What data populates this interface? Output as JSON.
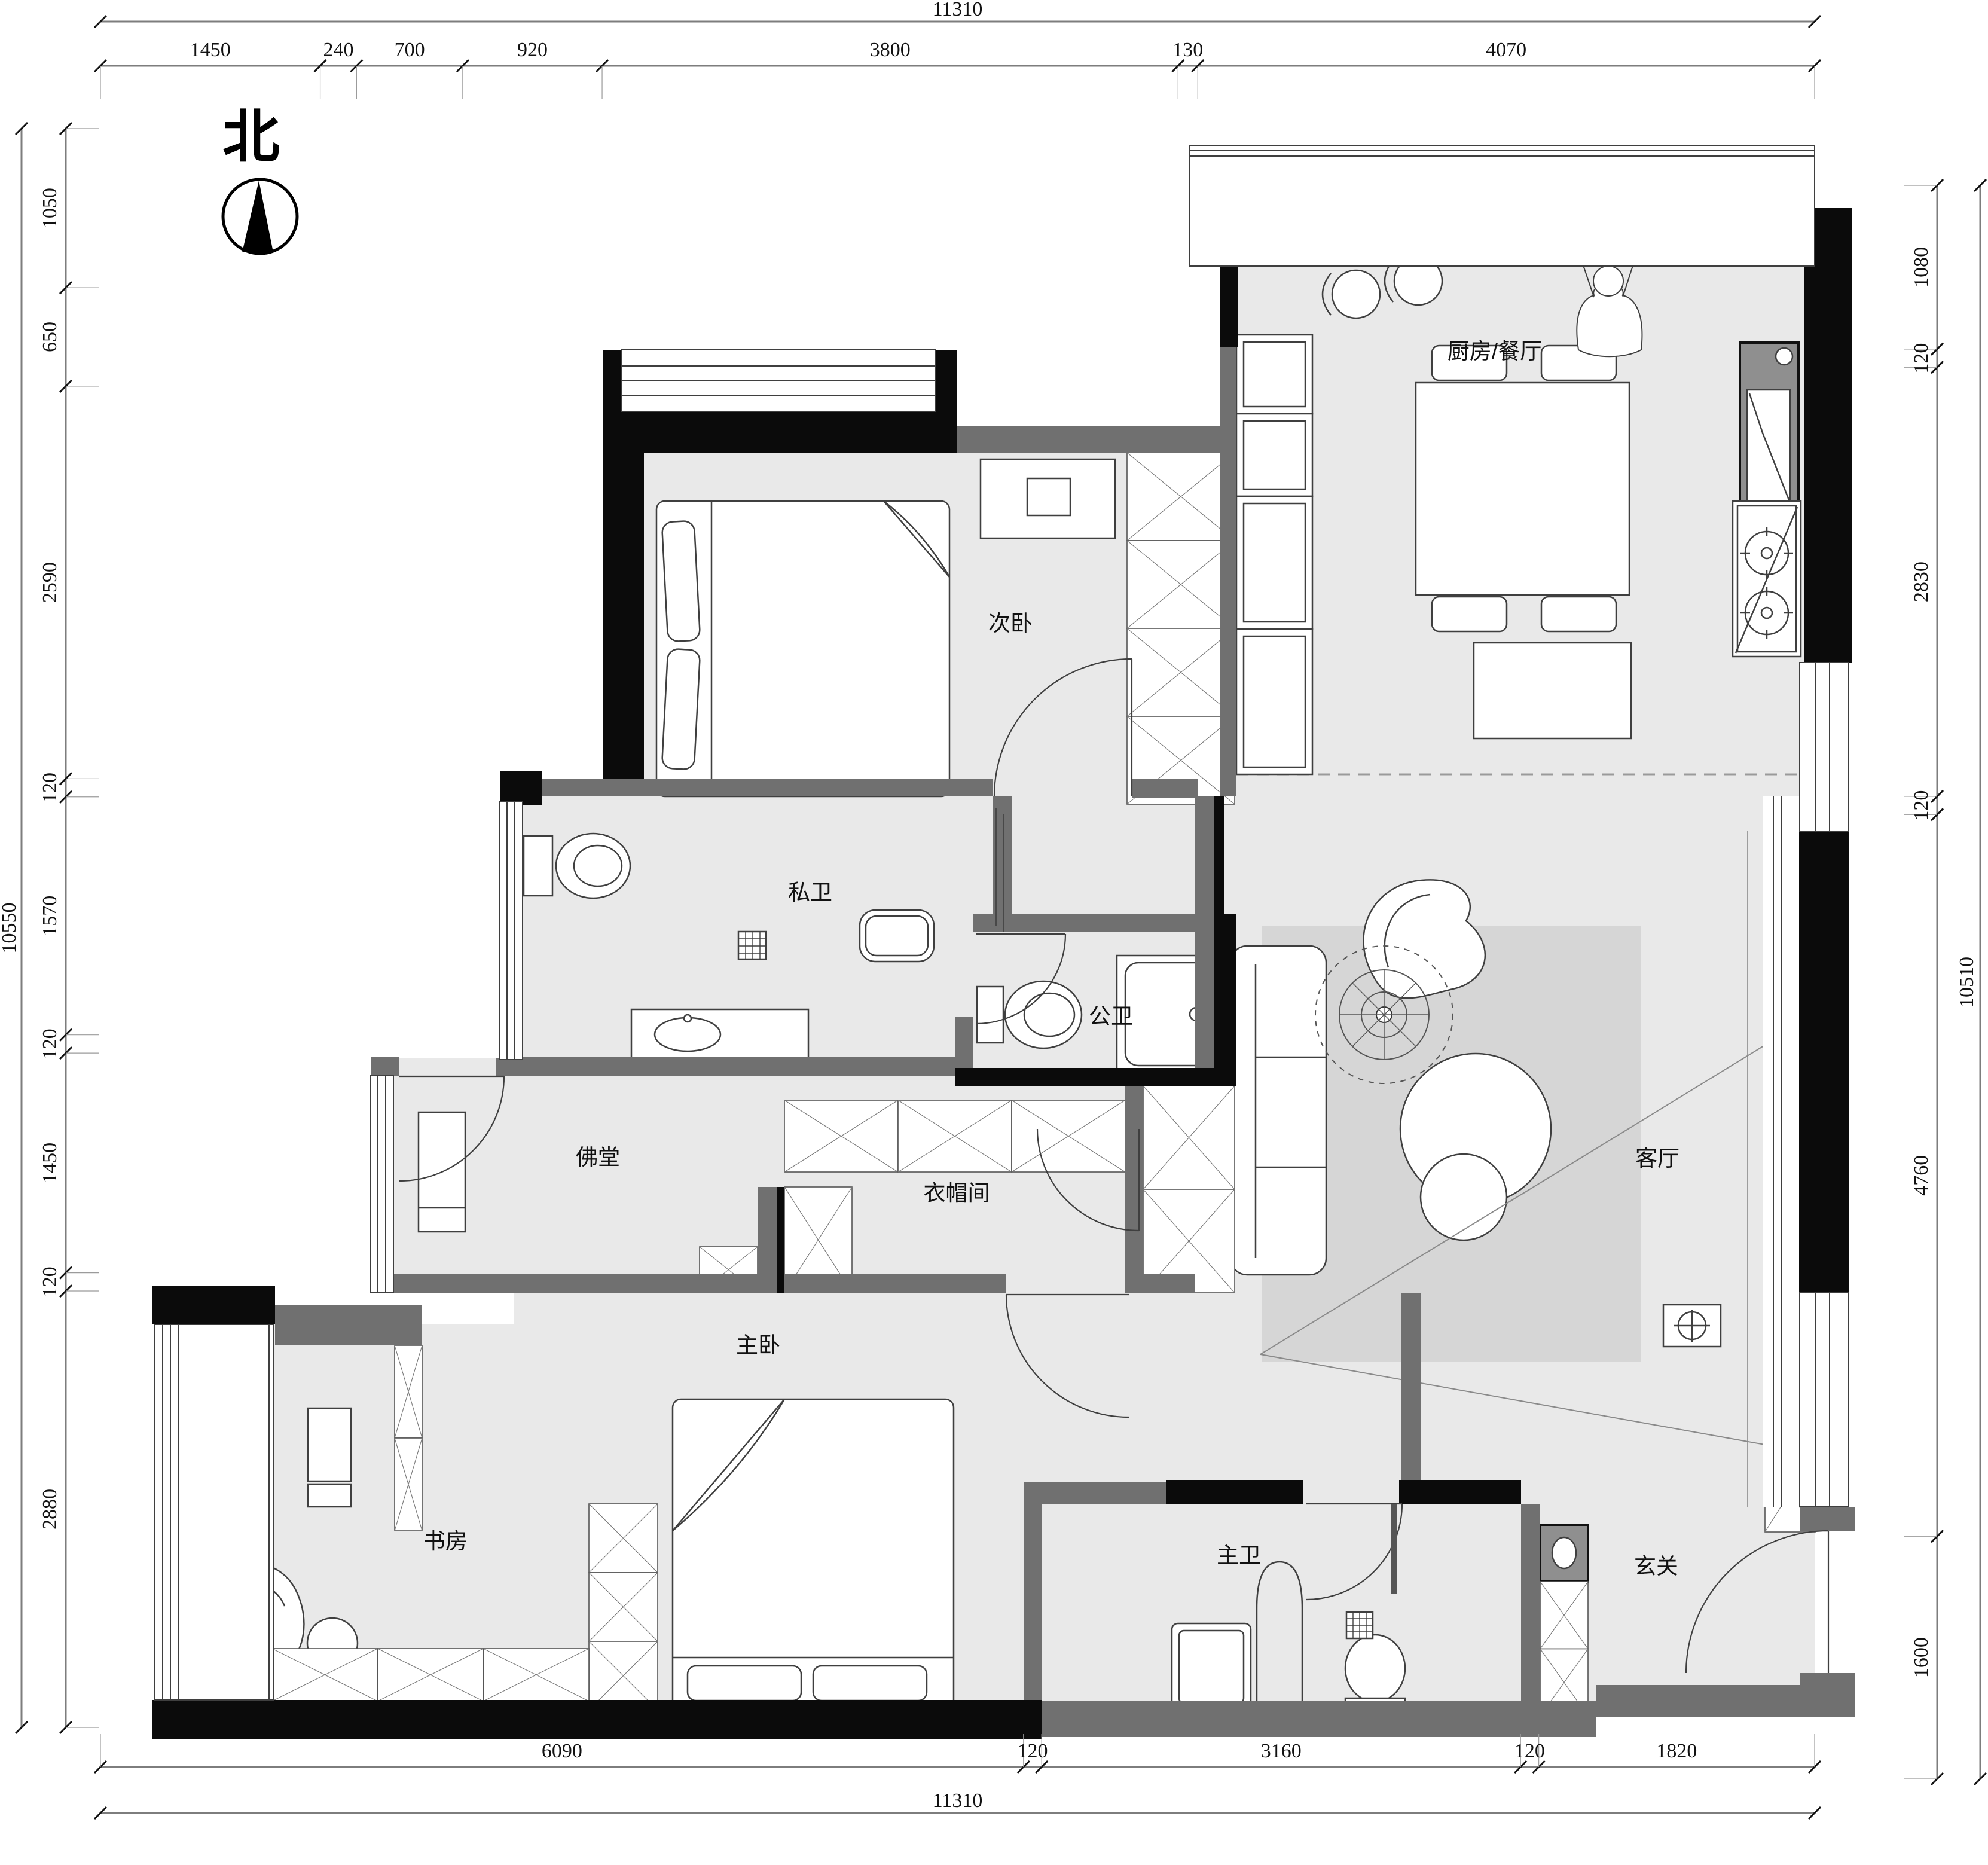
{
  "compass": {
    "label": "北"
  },
  "rooms": [
    {
      "id": "secondary-bedroom",
      "label": "次卧"
    },
    {
      "id": "kitchen-dining",
      "label": "厨房/餐厅"
    },
    {
      "id": "private-bath",
      "label": "私卫"
    },
    {
      "id": "public-bath",
      "label": "公卫"
    },
    {
      "id": "buddhist-hall",
      "label": "佛堂"
    },
    {
      "id": "cloakroom",
      "label": "衣帽间"
    },
    {
      "id": "living-room",
      "label": "客厅"
    },
    {
      "id": "master-bedroom",
      "label": "主卧"
    },
    {
      "id": "study",
      "label": "书房"
    },
    {
      "id": "master-bath",
      "label": "主卫"
    },
    {
      "id": "entryway",
      "label": "玄关"
    }
  ],
  "dimensions": {
    "top": {
      "total": 11310,
      "segments": [
        1450,
        240,
        700,
        920,
        3800,
        130,
        4070
      ]
    },
    "bottom": {
      "total": 11310,
      "segments": [
        6090,
        120,
        3160,
        120,
        1820
      ]
    },
    "left": {
      "total": 10550,
      "segments": [
        1050,
        650,
        2590,
        120,
        1570,
        120,
        1450,
        120,
        2880
      ]
    },
    "right": {
      "total": 10510,
      "segments": [
        1080,
        120,
        2830,
        120,
        4760,
        1600
      ]
    }
  },
  "colors": {
    "floor": "#e9e9e9",
    "rug": "#d6d6d6",
    "wall": "#707070",
    "wall_dark": "#0b0b0b",
    "line": "#3f3f3f",
    "dim_line": "#7d7d7d",
    "text": "#111111",
    "appliance": "#8f8f8f"
  }
}
